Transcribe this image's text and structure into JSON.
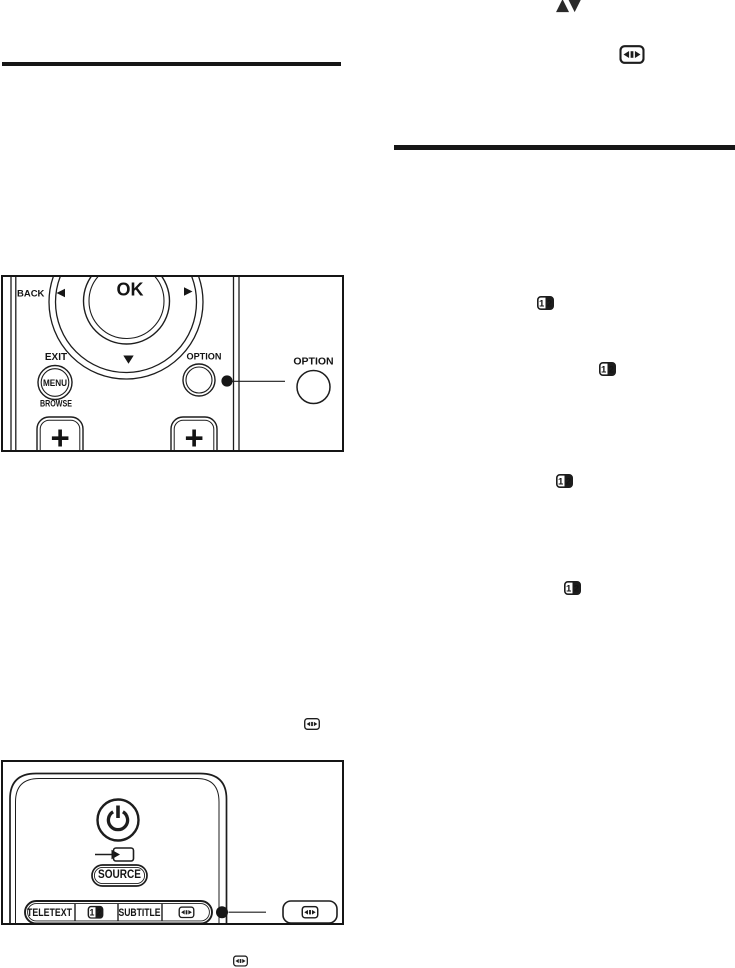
{
  "colors": {
    "paper": "#ffffff",
    "ink": "#1d1d1d"
  },
  "inline_icons": {
    "nav_up_down_glyphs": "▲▼",
    "nav_up_down_name": "up-down-arrows-icon",
    "picture_format_name": "picture-format-icon",
    "dual_screen_name": "dual-screen-icon",
    "dual_screen_left_digit": "1",
    "dual_screen_right_digit": "2"
  },
  "remote_nav_figure": {
    "back_label": "BACK",
    "ok_label": "OK",
    "exit_label": "EXIT",
    "menu_label": "MENU",
    "browse_label": "BROWSE",
    "option_key_label": "OPTION",
    "option_callout_label": "OPTION",
    "volume_up_label": "+",
    "channel_up_label": "+"
  },
  "remote_top_figure": {
    "source_label": "SOURCE",
    "teletext_label": "TELETEXT",
    "subtitle_label": "SUBTITLE",
    "power_icon": "power-icon",
    "source_input_icon": "source-input-icon",
    "picture_format_callout_icon": "picture-format-icon"
  }
}
